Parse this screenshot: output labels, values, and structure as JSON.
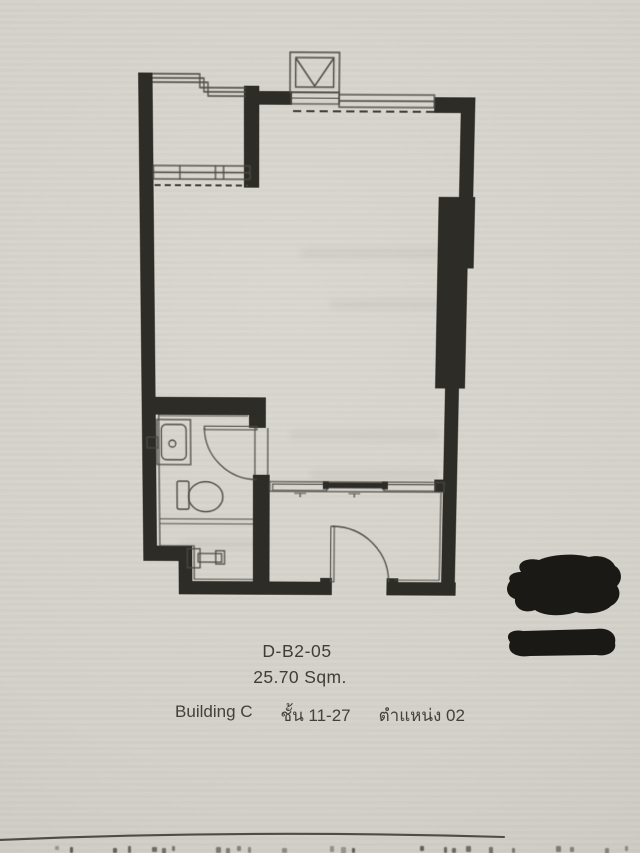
{
  "caption": {
    "unit_code": "D-B2-05",
    "area": "25.70 Sqm.",
    "building": "Building C",
    "floor_range": "ชั้น 11-27",
    "position": "ตำแหน่ง 02"
  },
  "plan": {
    "kind": "condominium unit floor plan",
    "features": [
      "balcony with railing and window (top-left)",
      "shaft-vent symbol (top-center)",
      "full-width window (top-right)",
      "structural column (right wall)",
      "bathroom with sink, toilet, swing door (bottom-left)",
      "sliding door partition (center-bottom)",
      "entrance swing door (bottom)"
    ],
    "redaction_markers": 2
  },
  "colors": {
    "paper": "#d5d2cb",
    "wall_ink": "#2e2c27",
    "thin_line": "#4d4a44",
    "redaction": "#1b1915"
  },
  "icons": {
    "shaft": "square-with-v-diagonals",
    "toilet": "tank-and-oval-bowl",
    "sink": "counter-with-basin-and-faucet",
    "door": "quarter-circle-swing-arc"
  }
}
